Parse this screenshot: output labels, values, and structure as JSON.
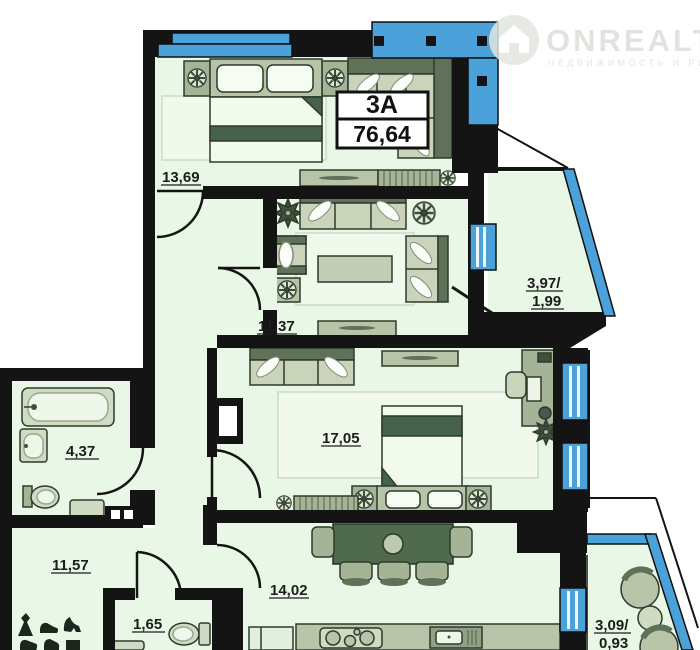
{
  "watermark": {
    "brand": "ONREALT",
    "tagline": "НЕДВИЖИМОСТЬ И РИЭЛТОРЫ"
  },
  "apartment": {
    "type_label": "3А",
    "total_area": "76,64"
  },
  "rooms": [
    {
      "key": "bedroom-top",
      "area": "13,69"
    },
    {
      "key": "living-room",
      "area": "11,37"
    },
    {
      "key": "loggia-right",
      "area_line1": "3,97/",
      "area_line2": "1,99"
    },
    {
      "key": "bathroom",
      "area": "4,37"
    },
    {
      "key": "bedroom-main",
      "area": "17,05"
    },
    {
      "key": "hallway",
      "area": "11,57"
    },
    {
      "key": "kitchen-dining",
      "area": "14,02"
    },
    {
      "key": "wc",
      "area": "1,65"
    },
    {
      "key": "loggia-bottom",
      "area_line1": "3,09/",
      "area_line2": "0,93"
    }
  ],
  "colors": {
    "floor": "#e9f8e6",
    "wall": "#141414",
    "glazing_blue": "#4ba1d9",
    "furniture_light": "#c9d4ba",
    "furniture_dark": "#5f7158",
    "table_dark": "#4f6a4c"
  }
}
